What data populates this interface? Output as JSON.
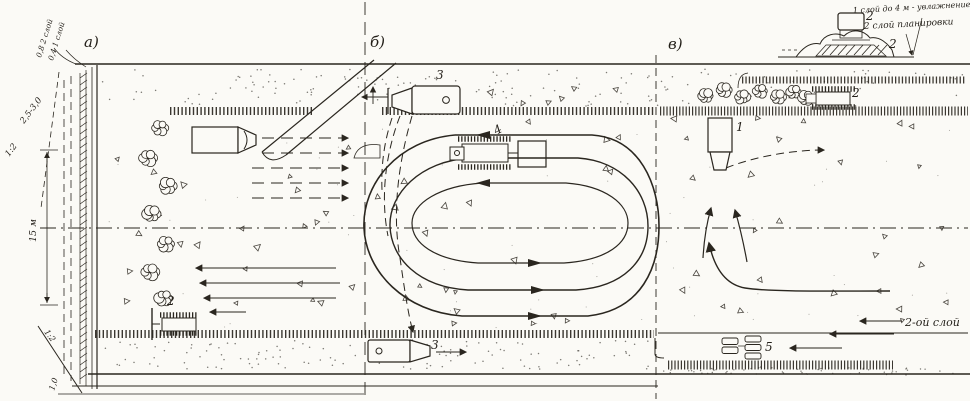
{
  "palette": {
    "ink": "#2a261f",
    "paper": "#fbfaf6"
  },
  "sections": {
    "a": "а)",
    "b": "б)",
    "v": "в)"
  },
  "annotations": {
    "layer_line_2": "0,8  2 слой",
    "layer_line_1": "0,4  1 слой",
    "width_range": "2,5-3,0",
    "slope_upper": "1:2",
    "height_dim": "15 м",
    "slope_lower": "1:2",
    "berm_width": "1,0",
    "note_line1": "1 слой до 4 м - увлажнение",
    "note_line2": "2 слой планировки",
    "second_layer": "2-ой слой"
  },
  "machine_labels": {
    "scraper_v": "1",
    "dozer_a": "2",
    "tractor_v": "2",
    "scraper_b_top": "3",
    "scraper_b_bottom": "3",
    "compactor_b": "4",
    "roller_v": "5",
    "inset_roller": "2",
    "inset_layer": "2"
  }
}
